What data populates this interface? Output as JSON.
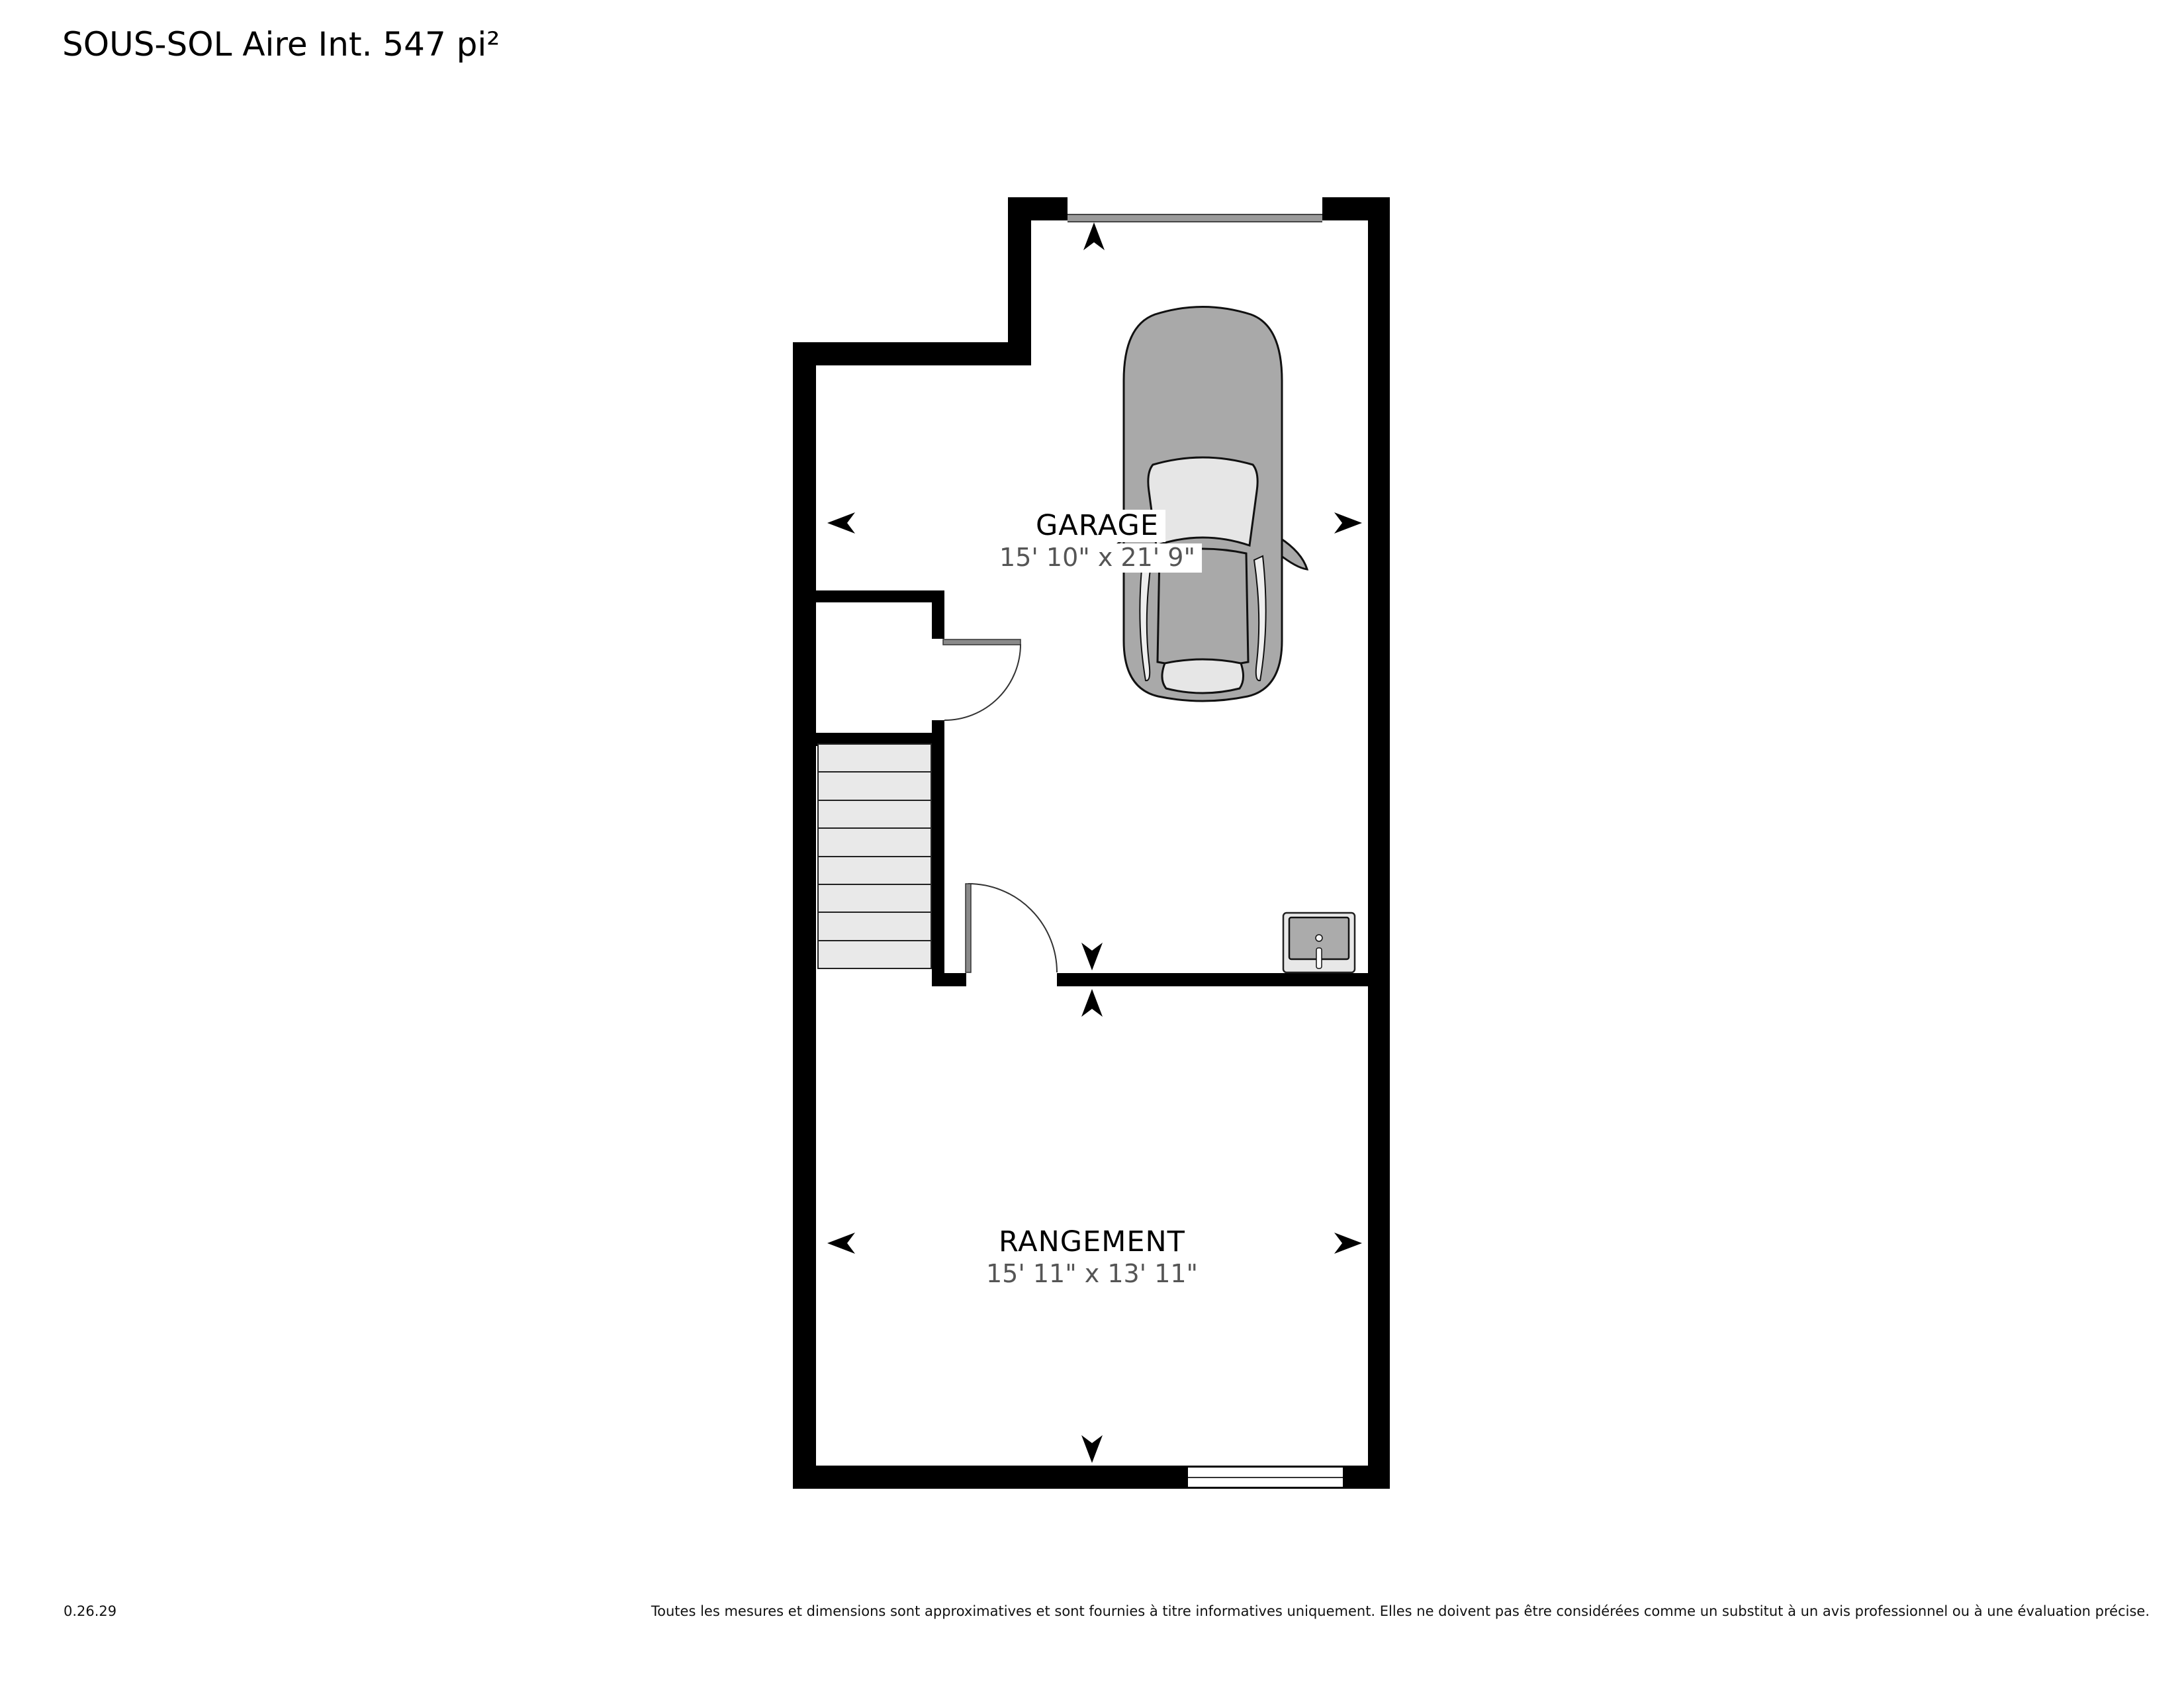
{
  "title": "SOUS-SOL Aire Int. 547 pi²",
  "rooms": [
    {
      "id": "garage",
      "name": "GARAGE",
      "dimensions": "15' 10\" x 21' 9\""
    },
    {
      "id": "rangement",
      "name": "RANGEMENT",
      "dimensions": "15' 11\" x 13' 11\""
    }
  ],
  "stairs": {
    "steps": 8
  },
  "fixtures": [
    {
      "icon": "car-icon",
      "location": "garage"
    },
    {
      "icon": "sink-icon",
      "location": "garage"
    },
    {
      "icon": "garage-door",
      "location": "garage-top-wall"
    },
    {
      "icon": "window",
      "location": "rangement-bottom-wall"
    }
  ],
  "footer": {
    "version": "0.26.29",
    "disclaimer": "Toutes les mesures et dimensions sont approximatives et sont fournies à titre informatives uniquement. Elles ne doivent pas être considérées comme un substitut à un avis professionnel ou à une évaluation précise."
  },
  "colors": {
    "wall": "#000000",
    "garage_door": "#9a9a9a",
    "stair_tread": "#e9e9e9",
    "door_panel": "#8a8a8a",
    "car_body": "#a9a9a9",
    "glass": "#e6e6e6",
    "dimension_text": "#555555",
    "background": "#ffffff"
  }
}
